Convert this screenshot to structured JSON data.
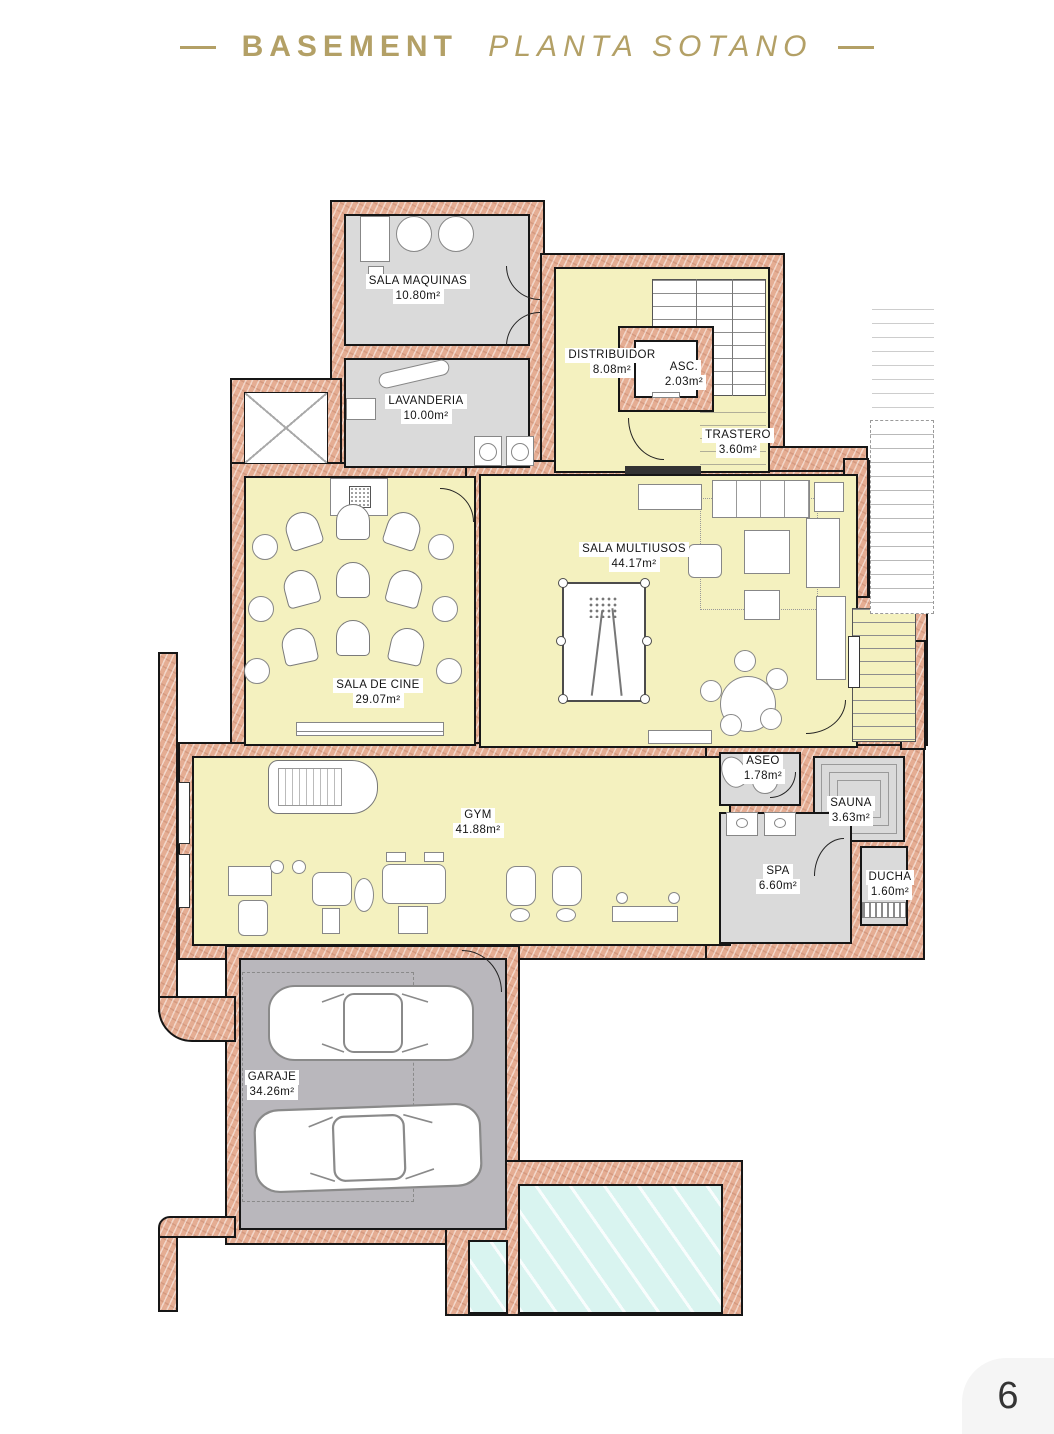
{
  "header": {
    "title": "BASEMENT",
    "subtitle": "PLANTA SOTANO"
  },
  "page": {
    "number": "6"
  },
  "rooms": [
    {
      "id": "sala-maquinas",
      "name": "SALA MAQUINAS",
      "area": "10.80m²"
    },
    {
      "id": "lavanderia",
      "name": "LAVANDERIA",
      "area": "10.00m²"
    },
    {
      "id": "distribuidor",
      "name": "DISTRIBUIDOR",
      "area": "8.08m²"
    },
    {
      "id": "ascensor",
      "name": "ASC.",
      "area": "2.03m²"
    },
    {
      "id": "trastero",
      "name": "TRASTERO",
      "area": "3.60m²"
    },
    {
      "id": "sala-multiusos",
      "name": "SALA MULTIUSOS",
      "area": "44.17m²"
    },
    {
      "id": "sala-de-cine",
      "name": "SALA DE CINE",
      "area": "29.07m²"
    },
    {
      "id": "gym",
      "name": "GYM",
      "area": "41.88m²"
    },
    {
      "id": "aseo",
      "name": "ASEO",
      "area": "1.78m²"
    },
    {
      "id": "sauna",
      "name": "SAUNA",
      "area": "3.63m²"
    },
    {
      "id": "spa",
      "name": "SPA",
      "area": "6.60m²"
    },
    {
      "id": "ducha",
      "name": "DUCHA",
      "area": "1.60m²"
    },
    {
      "id": "garaje",
      "name": "GARAJE",
      "area": "34.26m²"
    }
  ],
  "colors": {
    "accent_gold": "#b3a066",
    "wall": "#e5ad93",
    "room_yellow": "#f4f1bf",
    "room_gray": "#dadada",
    "garage_gray": "#b9b7bc",
    "pool_cyan": "#d9f4f0"
  }
}
